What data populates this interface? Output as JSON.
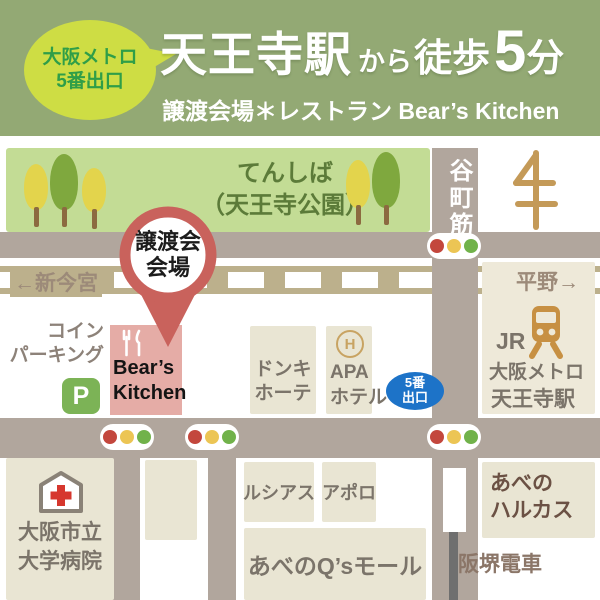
{
  "header": {
    "exit_badge": {
      "line1": "大阪メトロ",
      "line2": "5番出口"
    },
    "title": {
      "station": "天王寺駅",
      "from": "から",
      "walk": "徒歩",
      "minutes": "5",
      "unit": "分"
    },
    "subtitle": "譲渡会場＊レストラン Bear’s Kitchen"
  },
  "map": {
    "park": {
      "name": "てんしば",
      "official": "（天王寺公園）"
    },
    "streets": {
      "tanimachi": "谷町筋",
      "shin_imamiya": "←新今宮",
      "hirano": "平野→",
      "hankai_tramway": "阪堺電車"
    },
    "pin": {
      "line1": "譲渡会",
      "line2": "会場"
    },
    "coin_parking": {
      "line1": "コイン",
      "line2": "パーキング",
      "symbol": "P"
    },
    "bears_kitchen": {
      "line1": "Bear’s",
      "line2": "Kitchen"
    },
    "donki": {
      "line1": "ドンキ",
      "line2": "ホーテ"
    },
    "apa_hotel": {
      "symbol": "H",
      "line1": "APA",
      "line2": "ホテル"
    },
    "exit5": {
      "line1": "5番",
      "line2": "出口"
    },
    "station": {
      "line1": "JR",
      "line2": "大阪メトロ",
      "line3": "天王寺駅"
    },
    "hospital": {
      "line1": "大阪市立",
      "line2": "大学病院"
    },
    "lucias": "ルシアス",
    "apollo": "アポロ",
    "qs_mall": "あべのQ’sモール",
    "harukas": {
      "line1": "あべの",
      "line2": "ハルカス"
    }
  },
  "icons": {
    "map-pin-icon": "red teardrop venue marker",
    "traffic-light-icon": "red-yellow-green signal pill",
    "tree-icon": "park tree",
    "parking-icon": "green P square",
    "fork-knife-icon": "restaurant cutlery",
    "hotel-icon": "circled H",
    "train-icon": "front of train",
    "hospital-icon": "house with red cross",
    "pagoda-icon": "stylized pagoda landmark",
    "tram-stop-icon": "white platform on road",
    "speech-bubble-icon": "yellow-green balloon"
  },
  "colors": {
    "header_green": "#93a974",
    "bubble_yellow": "#cedd44",
    "bubble_text_green": "#2f9e48",
    "park_green": "#c3dc95",
    "park_text_green": "#5c7b39",
    "road_taupe": "#b1a69d",
    "railway_khaki": "#bcb08c",
    "block_beige": "#e9e5d3",
    "bears_pink": "#e5aca6",
    "pin_red": "#c9625c",
    "parking_green": "#7cb356",
    "exit_blue": "#1d73c8",
    "signal_red": "#c3473d",
    "signal_yellow": "#ecc554",
    "signal_green": "#71b24a",
    "train_gold": "#c79043",
    "label_gray": "#7b746a",
    "street_label_brown": "#9c8a79",
    "harukas_text": "#6b5144"
  }
}
